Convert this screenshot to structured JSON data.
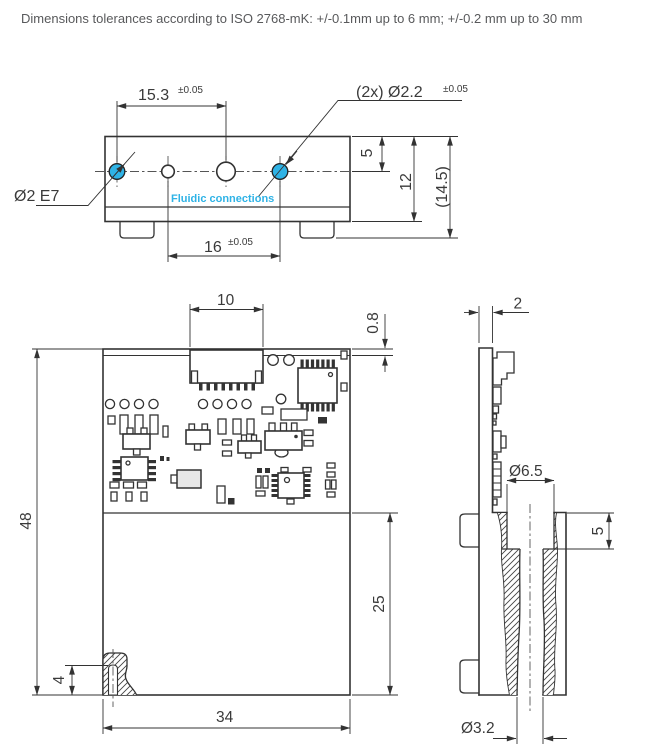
{
  "header": {
    "tolerance_note": "Dimensions tolerances according to ISO 2768-mK: +/-0.1mm up to 6 mm; +/-0.2 mm up to 30 mm"
  },
  "colors": {
    "accent": "#2fb3e6",
    "line": "#333333",
    "text": "#3a3a3a",
    "muted": "#58595b"
  },
  "top_view": {
    "dim_port_spacing": "15.3",
    "dim_port_spacing_tol": "±0.05",
    "callout_holes": "(2x) Ø2.2",
    "callout_holes_tol": "±0.05",
    "label_fit": "Ø2 E7",
    "label_fluidic": "Fluidic connections",
    "dim_bottom_spacing": "16",
    "dim_bottom_spacing_tol": "±0.05",
    "dim_port_depth": "5",
    "dim_body_height": "12",
    "dim_total_height": "(14.5)"
  },
  "pcb_view": {
    "dim_connector_width": "10",
    "dim_edge_offset": "0.8",
    "dim_board_height": "48",
    "dim_port_height": "4",
    "dim_board_width": "34",
    "dim_lower_section": "25"
  },
  "section_view": {
    "dim_pcb_thickness": "2",
    "dim_counterbore": "Ø6.5",
    "dim_counterbore_depth": "5",
    "dim_bore": "Ø3.2"
  }
}
